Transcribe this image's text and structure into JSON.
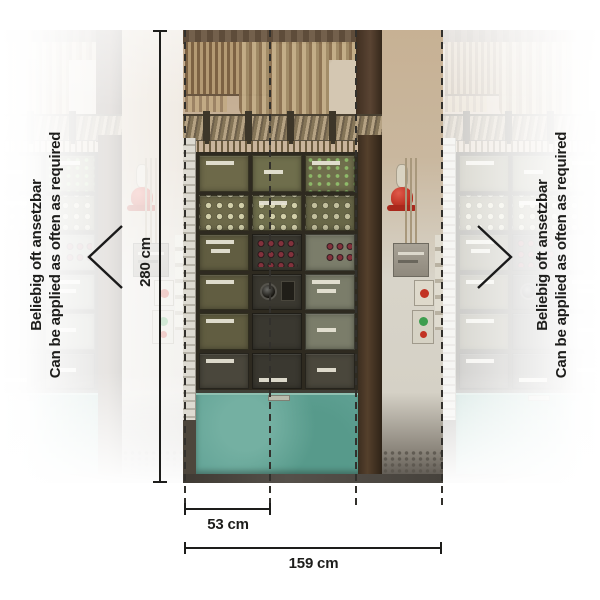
{
  "side_labels": {
    "left": {
      "line1": "Beliebig oft ansetzbar",
      "line2": "Can be applied as often as required"
    },
    "right": {
      "line1": "Beliebig oft ansetzbar",
      "line2": "Can be applied as often as required"
    }
  },
  "dimensions": {
    "height": "280 cm",
    "strip_width": "53 cm",
    "total_width": "159 cm"
  },
  "icons": {
    "left": "chevron-left",
    "right": "chevron-right"
  },
  "colors": {
    "annotation": "#1d1d1b",
    "teal_panel": "#62a396",
    "wall_tan": "#c2ab90",
    "cabinet_olive": "#6c6850",
    "alarm_red": "#b72b1d"
  }
}
